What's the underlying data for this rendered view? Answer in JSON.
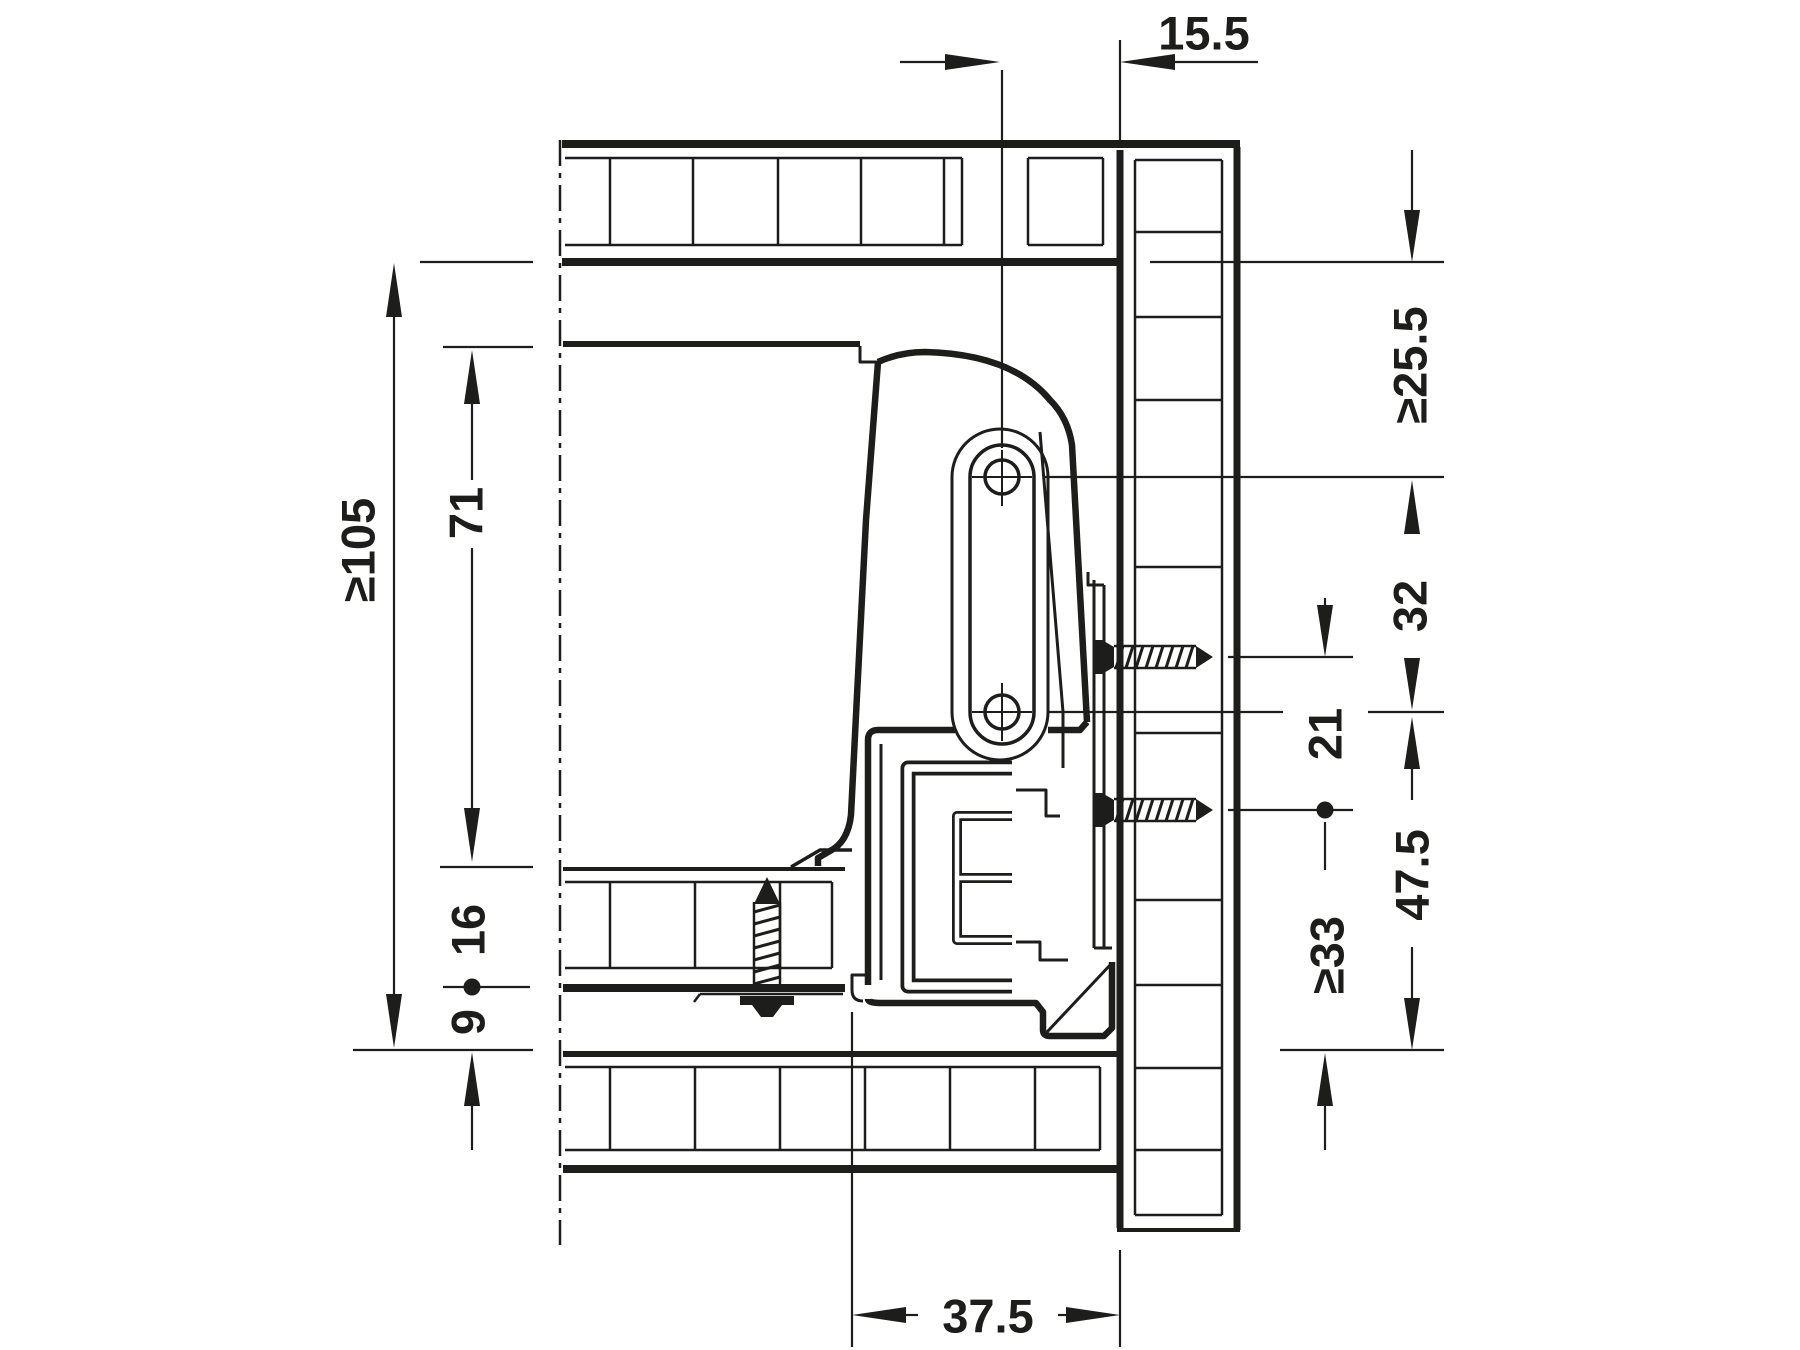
{
  "drawing": {
    "kind": "drawer-runner-installation-cross-section",
    "units": "mm",
    "colors": {
      "ink": "#1d1d1b",
      "background": "#ffffff"
    }
  },
  "dims": {
    "d15_5": "15.5",
    "d25_5": "≥25.5",
    "d32": "32",
    "d21": "21",
    "d47_5": "47.5",
    "d33": "≥33",
    "d105": "≥105",
    "d71": "71",
    "d16": "16",
    "d9": "9",
    "d37_5": "37.5"
  }
}
